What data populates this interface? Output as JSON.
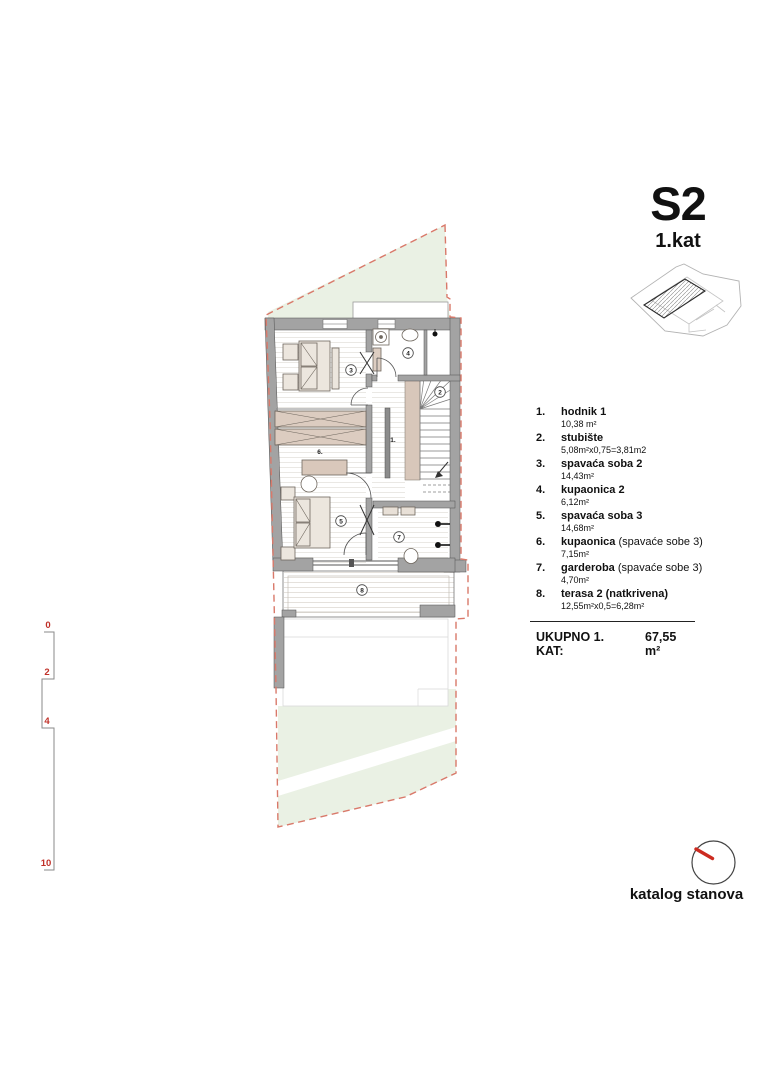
{
  "title": {
    "code": "S2",
    "floor": "1.kat"
  },
  "legend": {
    "items": [
      {
        "num": "1.",
        "name": "hodnik 1",
        "note": "",
        "area": "10,38 m²"
      },
      {
        "num": "2.",
        "name": "stubište",
        "note": "",
        "area": "5,08m²x0,75=3,81m2"
      },
      {
        "num": "3.",
        "name": "spavaća soba 2",
        "note": "",
        "area": "14,43m²"
      },
      {
        "num": "4.",
        "name": "kupaonica 2",
        "note": "",
        "area": "6,12m²"
      },
      {
        "num": "5.",
        "name": "spavaća soba 3",
        "note": "",
        "area": "14,68m²"
      },
      {
        "num": "6.",
        "name": "kupaonica",
        "note": "(spavaće sobe 3)",
        "area": "7,15m²"
      },
      {
        "num": "7.",
        "name": "garderoba",
        "note": "(spavaće sobe 3)",
        "area": "4,70m²"
      },
      {
        "num": "8.",
        "name": "terasa 2 (natkrivena)",
        "note": "",
        "area": "12,55m²x0,5=6,28m²"
      }
    ],
    "total_label": "UKUPNO 1. KAT:",
    "total_value": "67,55 m²"
  },
  "plan": {
    "room_labels": {
      "hodnik": "1.",
      "stubiste": "2",
      "spavaca_soba_2": "3",
      "kupaonica_2": "4",
      "spavaca_soba_3": "5",
      "kupaonica_3": "6.",
      "garderoba": "7",
      "terasa": "8"
    }
  },
  "scale_bar": {
    "labels": [
      "0",
      "2",
      "4",
      "10"
    ]
  },
  "footer": {
    "label": "katalog stanova"
  },
  "colors": {
    "boundary_red": "#d9796a",
    "scale_red": "#c03028",
    "north_red": "#cc2b20",
    "wall_gray": "#a3a3a3",
    "greenery": "#eaf1e4",
    "furniture_beige": "#d9c8bb"
  }
}
